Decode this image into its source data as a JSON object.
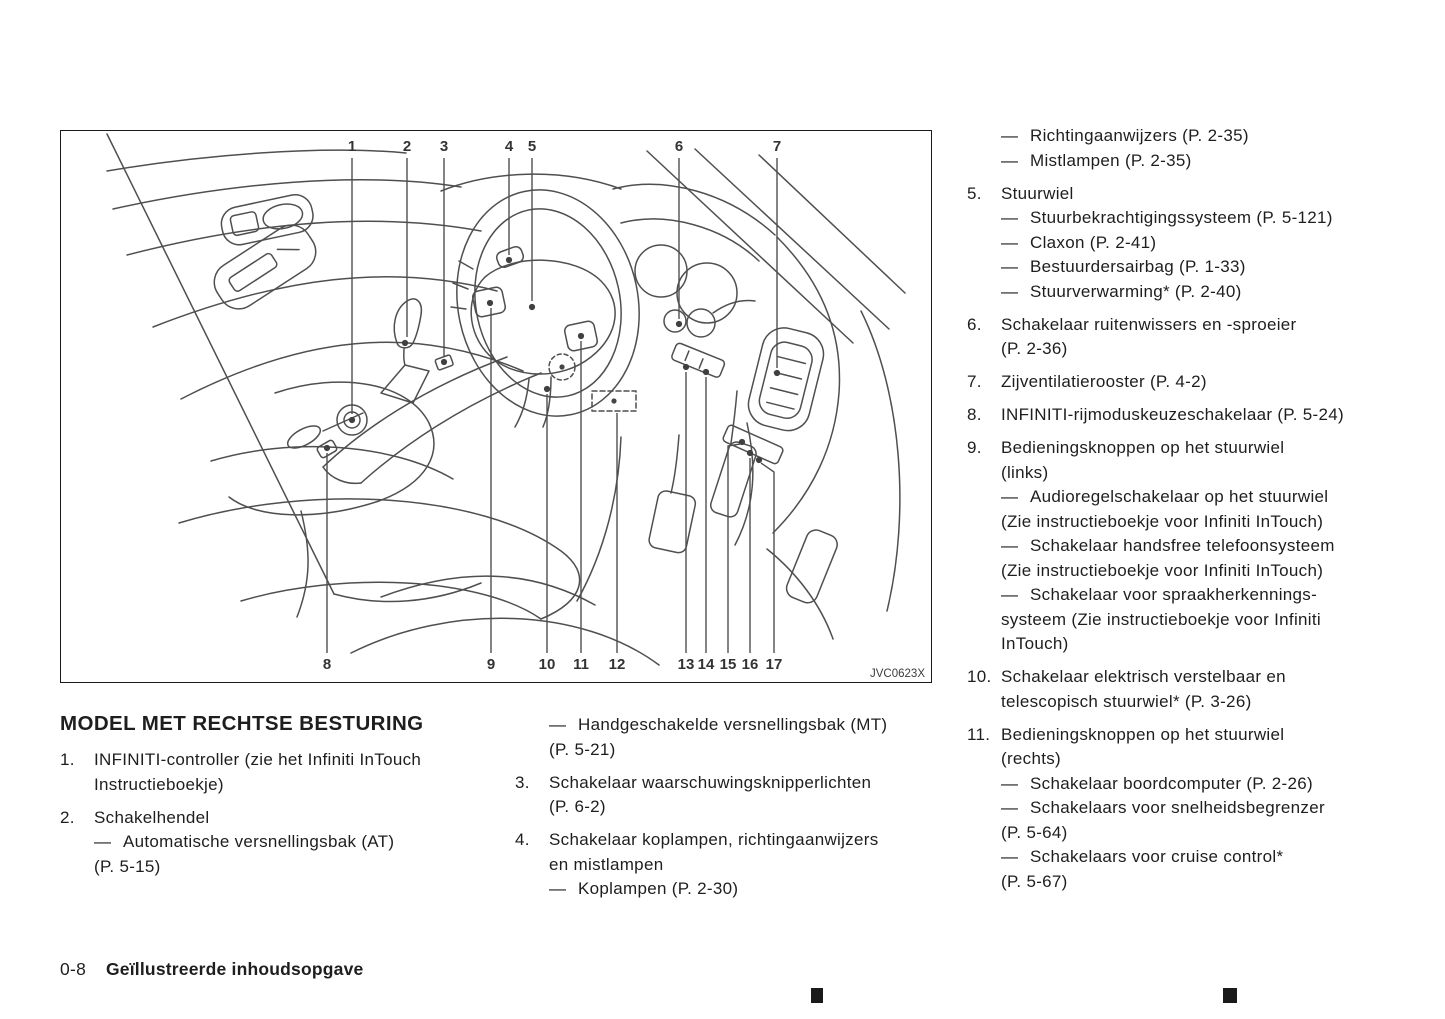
{
  "heading": "MODEL MET RECHTSE BESTURING",
  "footer": {
    "page_number": "0-8",
    "section_title": "Geïllustreerde inhoudsopgave"
  },
  "diagram": {
    "figure_code": "JVC0623X",
    "callouts": [
      {
        "n": "1",
        "x": 291,
        "y": 20,
        "pts": "291,27 291,283",
        "dot": "291,289"
      },
      {
        "n": "2",
        "x": 346,
        "y": 20,
        "pts": "346,27 346,206",
        "dot": "344,212"
      },
      {
        "n": "3",
        "x": 383,
        "y": 20,
        "pts": "383,27 383,226",
        "dot": "383,231"
      },
      {
        "n": "4",
        "x": 448,
        "y": 20,
        "pts": "448,27 448,124",
        "dot": "448,129"
      },
      {
        "n": "5",
        "x": 471,
        "y": 20,
        "pts": "471,27 471,170",
        "dot": "471,176"
      },
      {
        "n": "6",
        "x": 618,
        "y": 20,
        "pts": "618,27 618,188",
        "dot": "618,193"
      },
      {
        "n": "7",
        "x": 716,
        "y": 20,
        "pts": "716,27 716,237",
        "dot": "716,242"
      },
      {
        "n": "8",
        "x": 266,
        "y": 538,
        "pts": "266,522 266,322",
        "dot": "266,317"
      },
      {
        "n": "9",
        "x": 430,
        "y": 538,
        "pts": "430,522 430,177",
        "dot": "429,172"
      },
      {
        "n": "10",
        "x": 486,
        "y": 538,
        "pts": "486,522 486,263",
        "dot": "486,258"
      },
      {
        "n": "11",
        "x": 520,
        "y": 538,
        "pts": "520,522 520,210",
        "dot": "520,205"
      },
      {
        "n": "12",
        "x": 556,
        "y": 538,
        "pts": "556,522 556,282",
        "dot": ""
      },
      {
        "n": "13",
        "x": 625,
        "y": 538,
        "pts": "625,522 625,241",
        "dot": "625,236"
      },
      {
        "n": "14",
        "x": 645,
        "y": 538,
        "pts": "645,522 645,246",
        "dot": "645,241"
      },
      {
        "n": "15",
        "x": 667,
        "y": 538,
        "pts": "667,522 667,315 679,313",
        "dot": "681,311"
      },
      {
        "n": "16",
        "x": 689,
        "y": 538,
        "pts": "689,522 689,327",
        "dot": "689,322"
      },
      {
        "n": "17",
        "x": 713,
        "y": 538,
        "pts": "713,522 713,341 700,332",
        "dot": "698,329"
      }
    ]
  },
  "columns": {
    "left": [
      {
        "num": "1.",
        "lines": [
          {
            "t": "INFINITI-controller (zie het Infiniti InTouch"
          },
          {
            "t": "Instructieboekje)"
          }
        ]
      },
      {
        "num": "2.",
        "lines": [
          {
            "t": "Schakelhendel"
          },
          {
            "dash": true,
            "t": "Automatische versnellingsbak (AT)"
          },
          {
            "t": "(P. 5-15)"
          }
        ]
      }
    ],
    "middle": [
      {
        "lines": [
          {
            "dash": true,
            "t": "Handgeschakelde versnellingsbak (MT)"
          },
          {
            "t": "(P. 5-21)"
          }
        ]
      },
      {
        "num": "3.",
        "lines": [
          {
            "t": "Schakelaar waarschuwingsknipperlichten"
          },
          {
            "t": "(P. 6-2)"
          }
        ]
      },
      {
        "num": "4.",
        "lines": [
          {
            "t": "Schakelaar koplampen, richtingaanwijzers"
          },
          {
            "t": "en mistlampen"
          },
          {
            "dash": true,
            "t": "Koplampen (P. 2-30)"
          }
        ]
      }
    ],
    "right": [
      {
        "lines": [
          {
            "dash": true,
            "t": "Richtingaanwijzers (P. 2-35)"
          },
          {
            "dash": true,
            "t": "Mistlampen (P. 2-35)"
          }
        ]
      },
      {
        "num": "5.",
        "lines": [
          {
            "t": "Stuurwiel"
          },
          {
            "dash": true,
            "t": "Stuurbekrachtigingssysteem (P. 5-121)"
          },
          {
            "dash": true,
            "t": "Claxon (P. 2-41)"
          },
          {
            "dash": true,
            "t": "Bestuurdersairbag (P. 1-33)"
          },
          {
            "dash": true,
            "t": "Stuurverwarming* (P. 2-40)"
          }
        ]
      },
      {
        "num": "6.",
        "lines": [
          {
            "t": "Schakelaar ruitenwissers en -sproeier"
          },
          {
            "t": "(P. 2-36)"
          }
        ]
      },
      {
        "num": "7.",
        "lines": [
          {
            "t": "Zijventilatierooster (P. 4-2)"
          }
        ]
      },
      {
        "num": "8.",
        "lines": [
          {
            "t": "INFINITI-rijmoduskeuzeschakelaar (P. 5-24)"
          }
        ]
      },
      {
        "num": "9.",
        "lines": [
          {
            "t": "Bedieningsknoppen op het stuurwiel"
          },
          {
            "t": "(links)"
          },
          {
            "dash": true,
            "t": "Audioregelschakelaar op het stuurwiel"
          },
          {
            "t": "(Zie instructieboekje voor Infiniti InTouch)"
          },
          {
            "dash": true,
            "t": "Schakelaar handsfree telefoonsysteem"
          },
          {
            "t": "(Zie instructieboekje voor Infiniti InTouch)"
          },
          {
            "dash": true,
            "t": "Schakelaar voor spraakherkennings-"
          },
          {
            "t": "systeem (Zie instructieboekje voor Infiniti"
          },
          {
            "t": "InTouch)"
          }
        ]
      },
      {
        "num": "10.",
        "lines": [
          {
            "t": "Schakelaar elektrisch verstelbaar en"
          },
          {
            "t": "telescopisch stuurwiel* (P. 3-26)"
          }
        ]
      },
      {
        "num": "11.",
        "lines": [
          {
            "t": "Bedieningsknoppen op het stuurwiel"
          },
          {
            "t": "(rechts)"
          },
          {
            "dash": true,
            "t": "Schakelaar boordcomputer (P. 2-26)"
          },
          {
            "dash": true,
            "t": "Schakelaars voor snelheidsbegrenzer"
          },
          {
            "t": "(P. 5-64)"
          },
          {
            "dash": true,
            "t": "Schakelaars voor cruise control*"
          },
          {
            "t": "(P. 5-67)"
          }
        ]
      }
    ]
  }
}
